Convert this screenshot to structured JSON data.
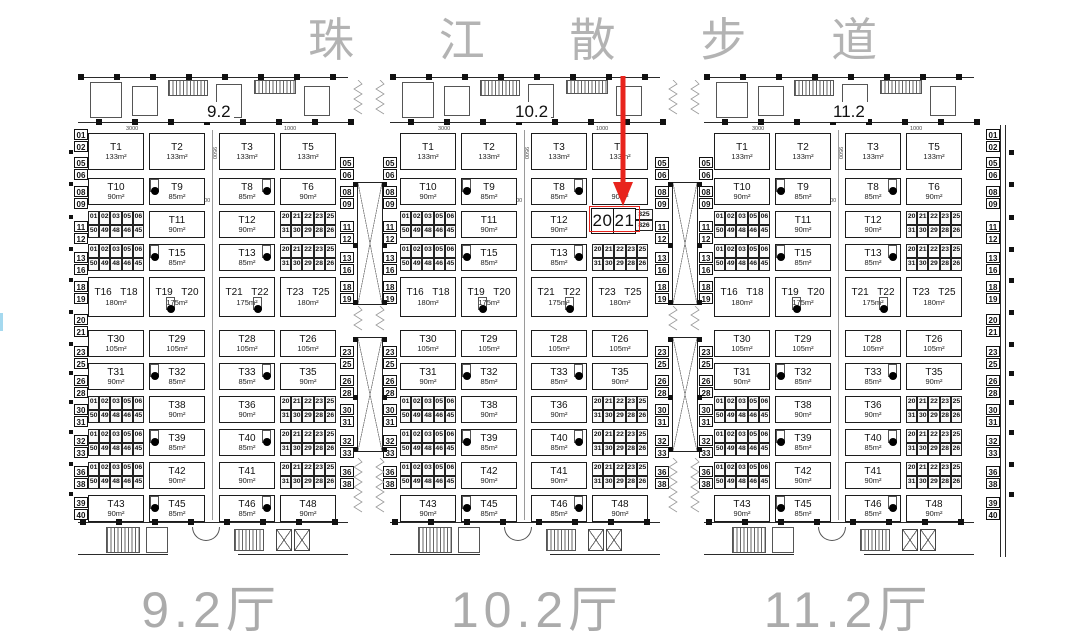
{
  "title": "珠 江 散 步 道",
  "halls": [
    {
      "id": "hall-9-2",
      "top_label": "9.2",
      "bottom_label": "9.2厅"
    },
    {
      "id": "hall-10-2",
      "top_label": "10.2",
      "bottom_label": "10.2厅",
      "highlight": {
        "row": 2,
        "col": 3,
        "text_left": "20",
        "text_right": "21",
        "tail_top": "325",
        "tail_bottom": "826"
      }
    },
    {
      "id": "hall-11-2",
      "top_label": "11.2",
      "bottom_label": "11.2厅"
    }
  ],
  "booth_rows": [
    {
      "tall": true,
      "cells": [
        {
          "booth": "T1",
          "area": "133m²"
        },
        {
          "booth": "T2",
          "area": "133m²"
        },
        {
          "booth": "T3",
          "area": "133m²"
        },
        {
          "booth": "T5",
          "area": "133m²"
        }
      ]
    },
    {
      "tall": false,
      "cells": [
        {
          "booth": "T10",
          "area": "90m²"
        },
        {
          "booth": "T9",
          "area": "85m²",
          "dot": "left"
        },
        {
          "booth": "T8",
          "area": "85m²",
          "dot": "right"
        },
        {
          "booth": "T6",
          "area": "90m²"
        }
      ]
    },
    {
      "tall": false,
      "cells": [
        {
          "strip": "left"
        },
        {
          "booth": "T11",
          "area": "90m²"
        },
        {
          "booth": "T12",
          "area": "90m²"
        },
        {
          "strip": "right"
        }
      ]
    },
    {
      "tall": false,
      "cells": [
        {
          "strip": "left"
        },
        {
          "booth": "T15",
          "area": "85m²",
          "dot": "left"
        },
        {
          "booth": "T13",
          "area": "85m²",
          "dot": "right"
        },
        {
          "strip": "right"
        }
      ]
    },
    {
      "tall": true,
      "cells": [
        {
          "booth": "T16 T18",
          "area": "180m²"
        },
        {
          "booth": "T19 T20",
          "area": "175m²",
          "dot": "bottom-left"
        },
        {
          "booth": "T21 T22",
          "area": "175m²",
          "dot": "bottom-right"
        },
        {
          "booth": "T23 T25",
          "area": "180m²"
        }
      ]
    },
    {
      "tall": false,
      "cells": [
        {
          "booth": "T30",
          "area": "105m²"
        },
        {
          "booth": "T29",
          "area": "105m²"
        },
        {
          "booth": "T28",
          "area": "105m²"
        },
        {
          "booth": "T26",
          "area": "105m²"
        }
      ]
    },
    {
      "tall": false,
      "cells": [
        {
          "booth": "T31",
          "area": "90m²"
        },
        {
          "booth": "T32",
          "area": "85m²",
          "dot": "left"
        },
        {
          "booth": "T33",
          "area": "85m²",
          "dot": "right"
        },
        {
          "booth": "T35",
          "area": "90m²"
        }
      ]
    },
    {
      "tall": false,
      "cells": [
        {
          "strip": "left"
        },
        {
          "booth": "T38",
          "area": "90m²"
        },
        {
          "booth": "T36",
          "area": "90m²"
        },
        {
          "strip": "right"
        }
      ]
    },
    {
      "tall": false,
      "cells": [
        {
          "strip": "left"
        },
        {
          "booth": "T39",
          "area": "85m²",
          "dot": "left"
        },
        {
          "booth": "T40",
          "area": "85m²",
          "dot": "right"
        },
        {
          "strip": "right"
        }
      ]
    },
    {
      "tall": false,
      "cells": [
        {
          "strip": "left"
        },
        {
          "booth": "T42",
          "area": "90m²"
        },
        {
          "booth": "T41",
          "area": "90m²"
        },
        {
          "strip": "right"
        }
      ]
    },
    {
      "tall": false,
      "cells": [
        {
          "booth": "T43",
          "area": "90m²"
        },
        {
          "booth": "T45",
          "area": "85m²",
          "dot": "left"
        },
        {
          "booth": "T46",
          "area": "85m²",
          "dot": "right"
        },
        {
          "booth": "T48",
          "area": "90m²"
        }
      ]
    }
  ],
  "digit_strips": {
    "left": {
      "top": [
        "01",
        "02",
        "03",
        "05",
        "06"
      ],
      "bottom": [
        "50",
        "49",
        "48",
        "46",
        "45"
      ]
    },
    "right": {
      "top": [
        "20",
        "21",
        "22",
        "23",
        "25"
      ],
      "bottom": [
        "31",
        "30",
        "29",
        "28",
        "26"
      ]
    }
  },
  "rail_pairs": [
    [
      "01",
      "02"
    ],
    [
      "05",
      "06"
    ],
    [
      "08",
      "09"
    ],
    [
      "11",
      "12"
    ],
    [
      "13",
      "16"
    ],
    [
      "18",
      "19"
    ],
    [
      "20",
      "21"
    ],
    [
      "23",
      "25"
    ],
    [
      "26",
      "28"
    ],
    [
      "30",
      "31"
    ],
    [
      "32",
      "33"
    ],
    [
      "36",
      "38"
    ],
    [
      "39",
      "40"
    ]
  ],
  "corridor_pairs_top_indexes": [
    1,
    2,
    3,
    4,
    5
  ],
  "corridor_pairs_bottom_indexes": [
    7,
    8,
    9,
    10,
    11
  ],
  "dimension_labels": {
    "d1": "3000",
    "d2": "1000",
    "d3": "6000",
    "d4": "9500"
  },
  "highlighted_booth": "2021",
  "colors": {
    "accent_red": "#e8241d",
    "plan_line": "#1c1c1c",
    "gray_text": "#b3b3b3"
  }
}
